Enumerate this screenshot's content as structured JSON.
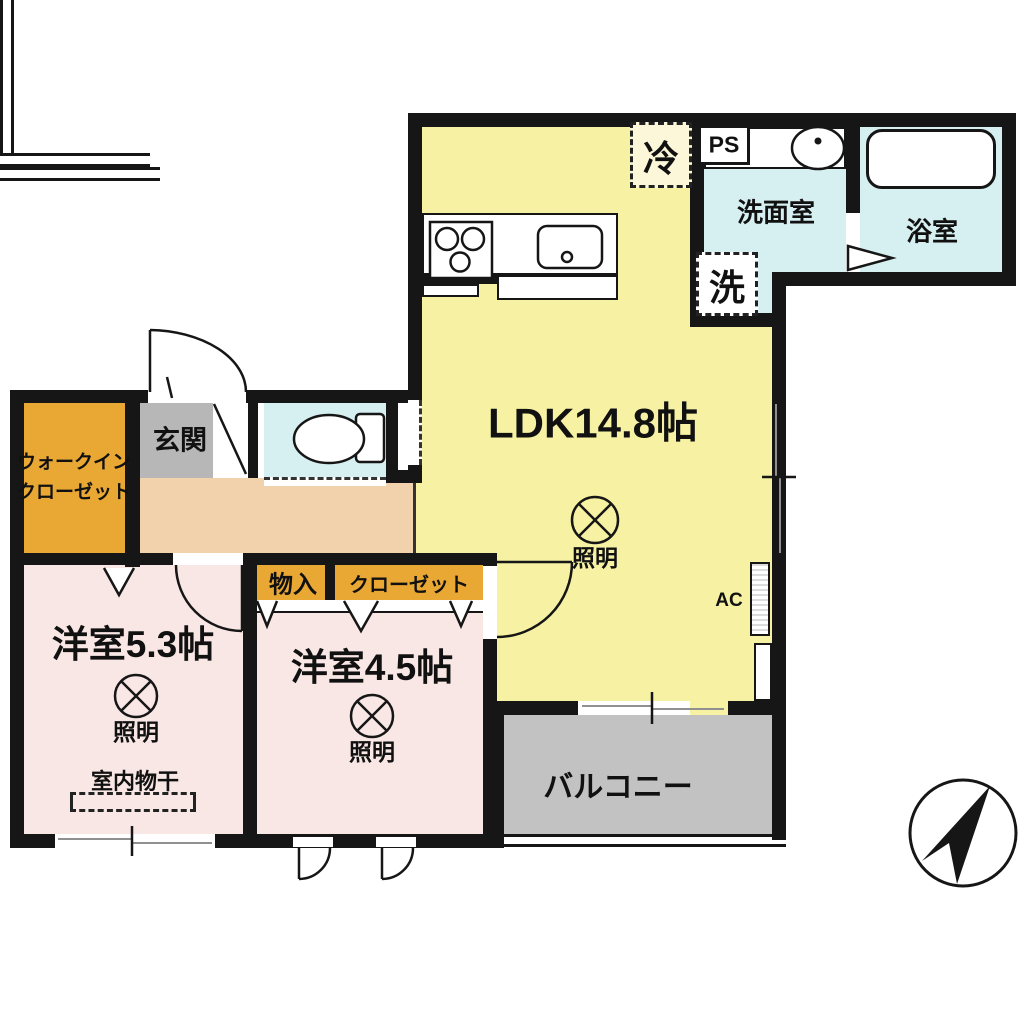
{
  "rooms": {
    "ldk": {
      "label": "LDK14.8帖"
    },
    "bedroom_53": {
      "label": "洋室5.3帖"
    },
    "bedroom_45": {
      "label": "洋室4.5帖"
    },
    "washroom": {
      "label": "洗面室"
    },
    "bathroom": {
      "label": "浴室"
    },
    "entrance": {
      "label": "玄関"
    },
    "walk_in_closet": {
      "line1": "ウォークイン",
      "line2": "クローゼット"
    },
    "balcony": {
      "label": "バルコニー"
    },
    "storage": {
      "label": "物入"
    },
    "closet": {
      "label": "クローゼット"
    }
  },
  "fixtures": {
    "fridge": "冷",
    "washer": "洗",
    "pipe_space": "PS",
    "air_con": "AC",
    "lighting": "照明",
    "indoor_drying": "室内物干"
  },
  "colors": {
    "ldk_yellow": "#f7f2a3",
    "wet_cyan": "#d6eff1",
    "bedroom_pink": "#f9e7e5",
    "closet_orange": "#e9a833",
    "hallway_peach": "#f1d2ad",
    "entrance_gray": "#b7b7b7",
    "balcony_gray": "#c2c2c2",
    "wall_black": "#161616"
  }
}
